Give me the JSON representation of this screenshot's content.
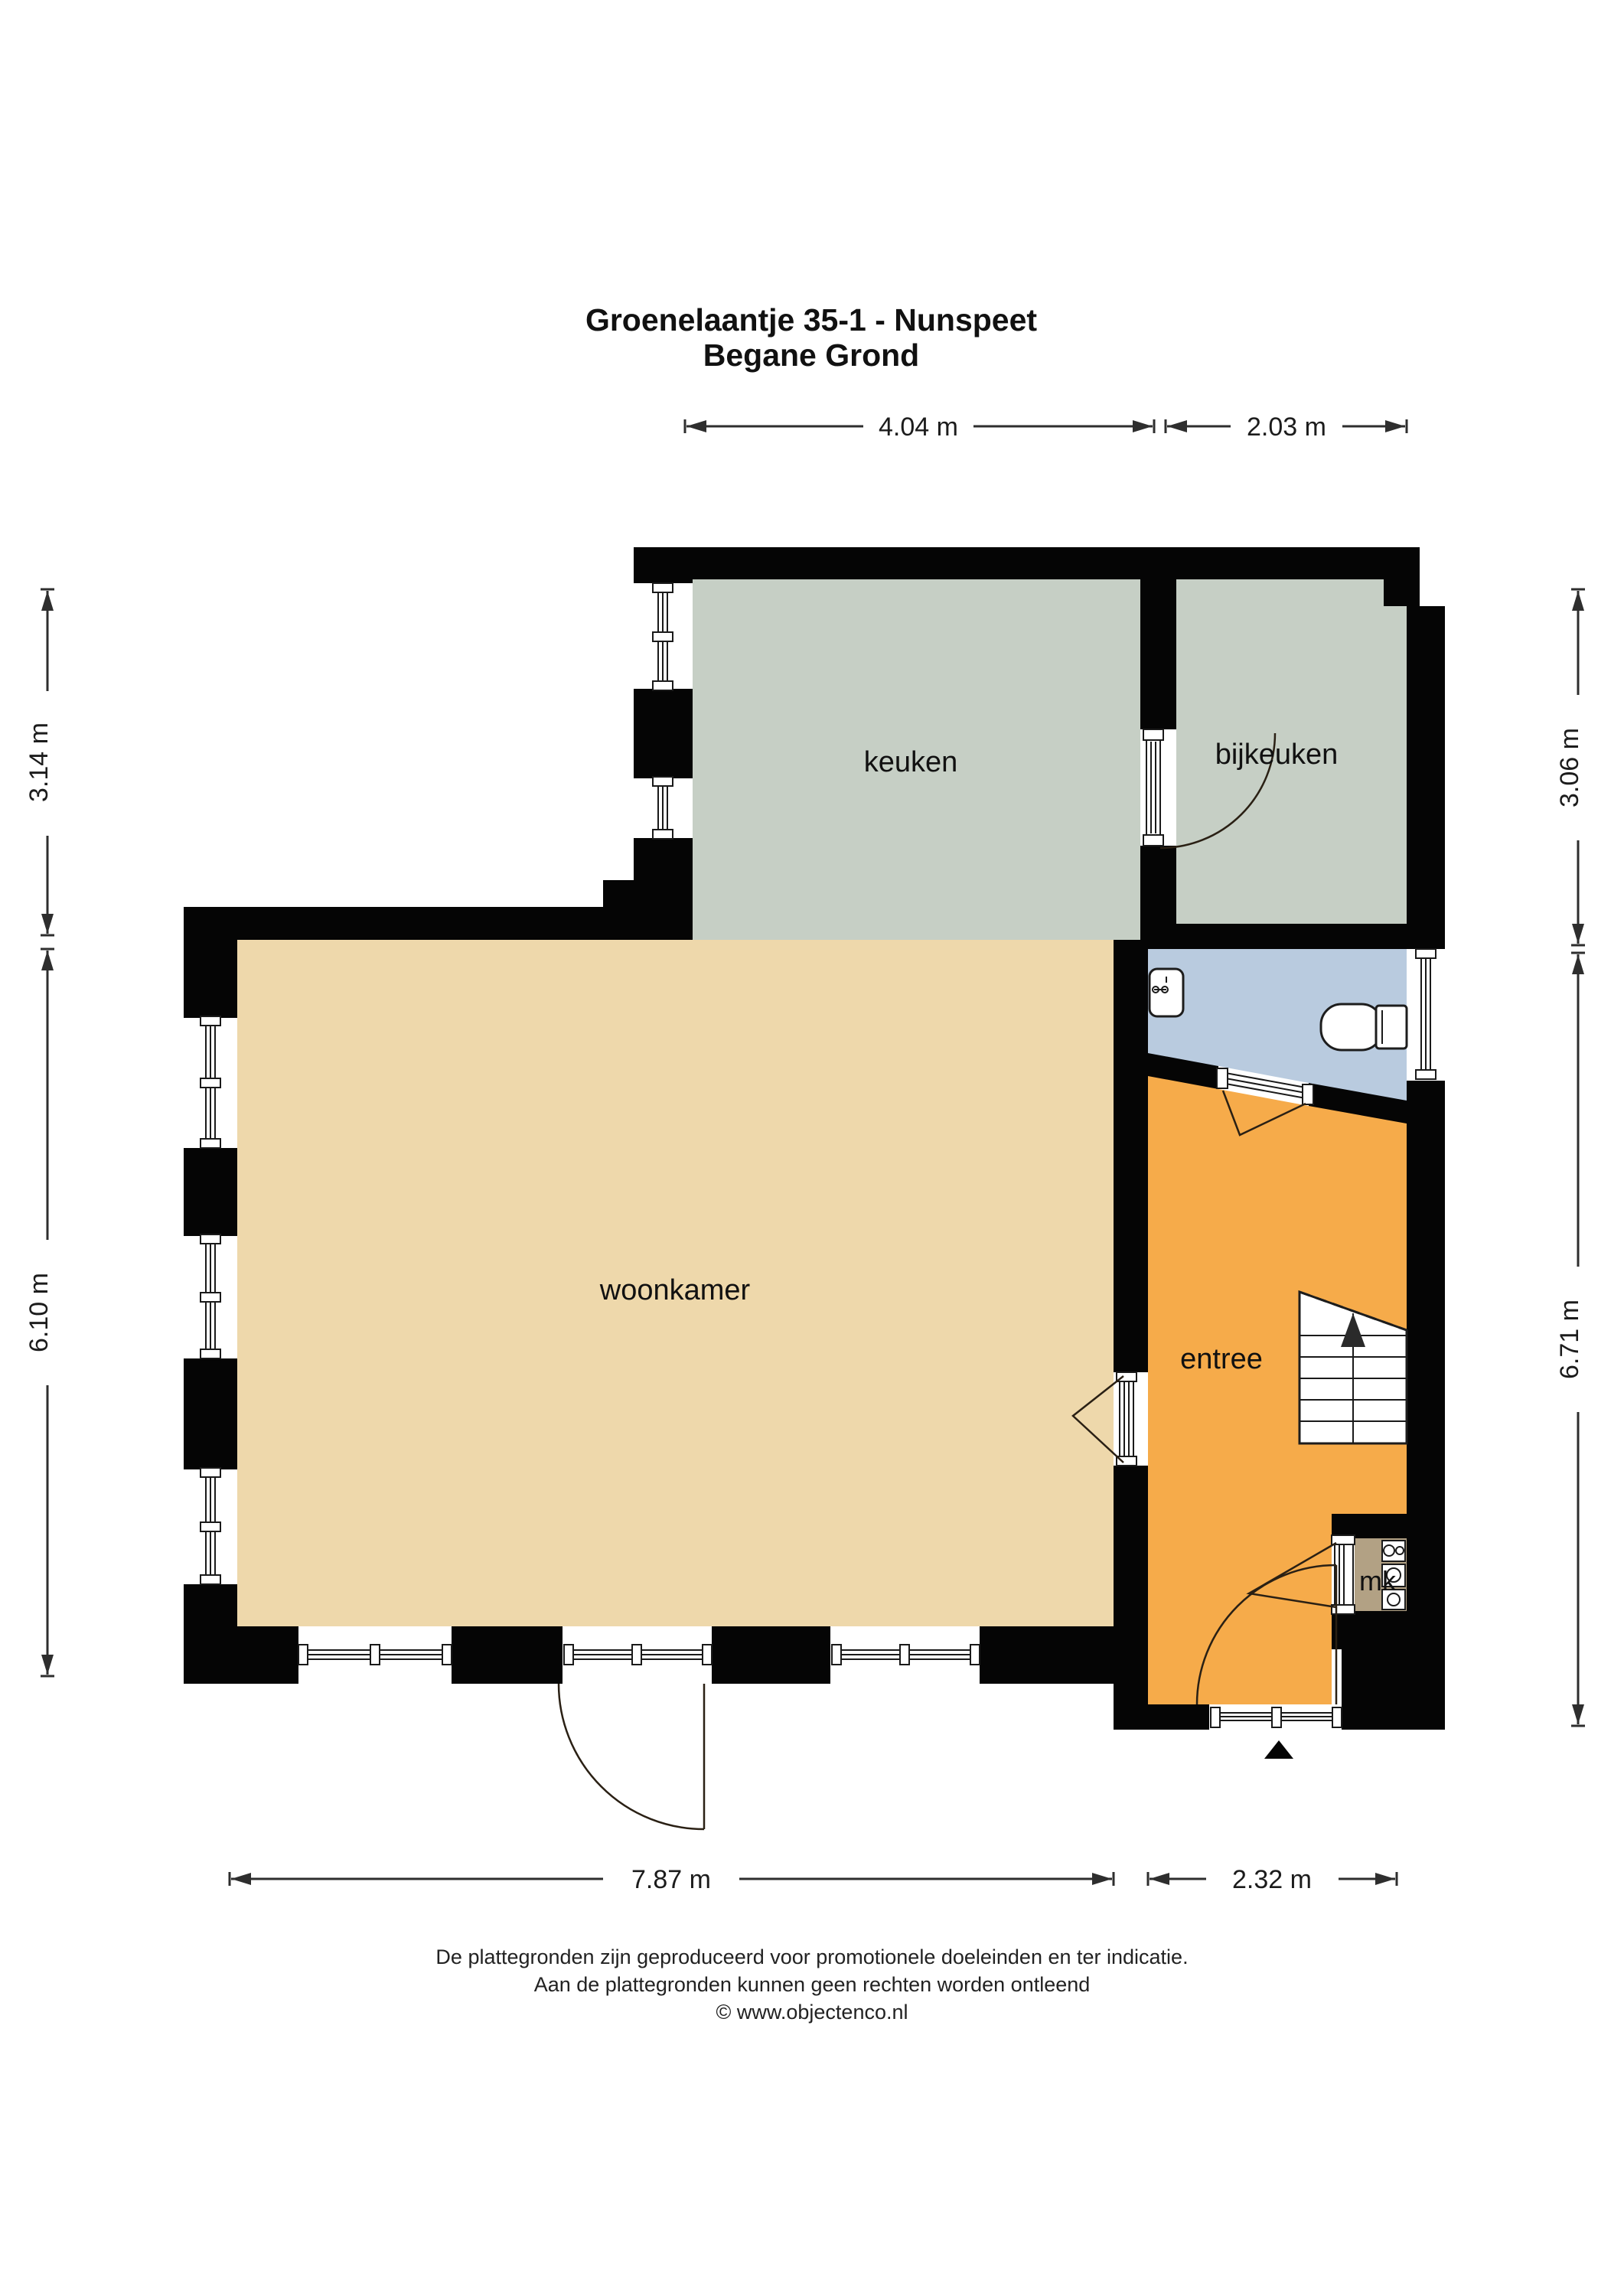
{
  "title": {
    "line1": "Groenelaantje 35-1 - Nunspeet",
    "line2": "Begane Grond"
  },
  "rooms": {
    "keuken": {
      "label": "keuken"
    },
    "bijkeuken": {
      "label": "bijkeuken"
    },
    "woonkamer": {
      "label": "woonkamer"
    },
    "entree": {
      "label": "entree"
    },
    "mk": {
      "label": "mk"
    }
  },
  "dimensions": {
    "top_left": "4.04 m",
    "top_right": "2.03 m",
    "left_upper": "3.14 m",
    "left_lower": "6.10 m",
    "right_upper": "3.06 m",
    "right_lower": "6.71 m",
    "bottom_left": "7.87 m",
    "bottom_right": "2.32 m"
  },
  "footer": {
    "line1": "De plattegronden zijn geproduceerd voor promotionele doeleinden en ter indicatie.",
    "line2": "Aan de plattegronden kunnen geen rechten worden ontleend",
    "line3": "© www.objectenco.nl"
  },
  "colors": {
    "wall": "#050505",
    "kitchen": "#c6cfc5",
    "utility": "#c6cfc5",
    "living": "#eed8ab",
    "hall": "#f6ab4a",
    "toilet": "#b9cbdf",
    "closet": "#b2a184",
    "background": "#ffffff"
  }
}
